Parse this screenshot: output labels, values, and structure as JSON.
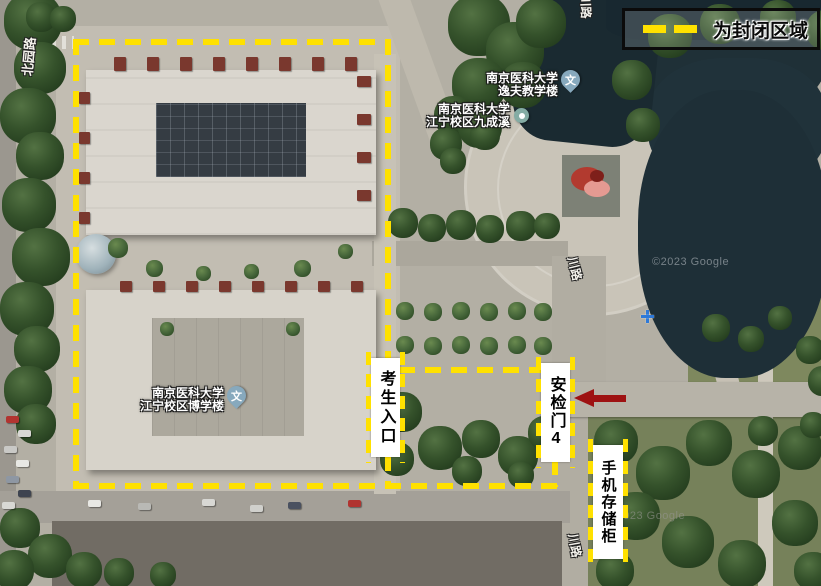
{
  "colors": {
    "boundary_dash_yellow": "#FFE100",
    "arrow_red": "#9E1212",
    "label_box_bg": "#FFFFFF",
    "label_text": "#000000",
    "legend_border": "#0B0B0B",
    "pond_water": "#1E2F37",
    "marker_pin_blue": "#87A9BD"
  },
  "legend": {
    "label": "为封闭区域"
  },
  "zones": {
    "entrance_label": "考生入口",
    "gate_label": "安检门4",
    "locker_label": "手机存储柜"
  },
  "poi": [
    {
      "line1": "南京医科大学",
      "line2": "逸夫教学楼",
      "glyph": "文"
    },
    {
      "line1": "南京医科大学",
      "line2": "江宁校区九成溪"
    },
    {
      "line1": "南京医科大学",
      "line2": "江宁校区博学楼",
      "glyph": "文"
    }
  ],
  "roads": [
    {
      "text": "北园路"
    },
    {
      "text": "川路"
    },
    {
      "text": "川路"
    },
    {
      "text": "川路"
    }
  ],
  "watermarks": [
    {
      "text": "©2023 Google"
    },
    {
      "text": "©2023 Google"
    }
  ]
}
